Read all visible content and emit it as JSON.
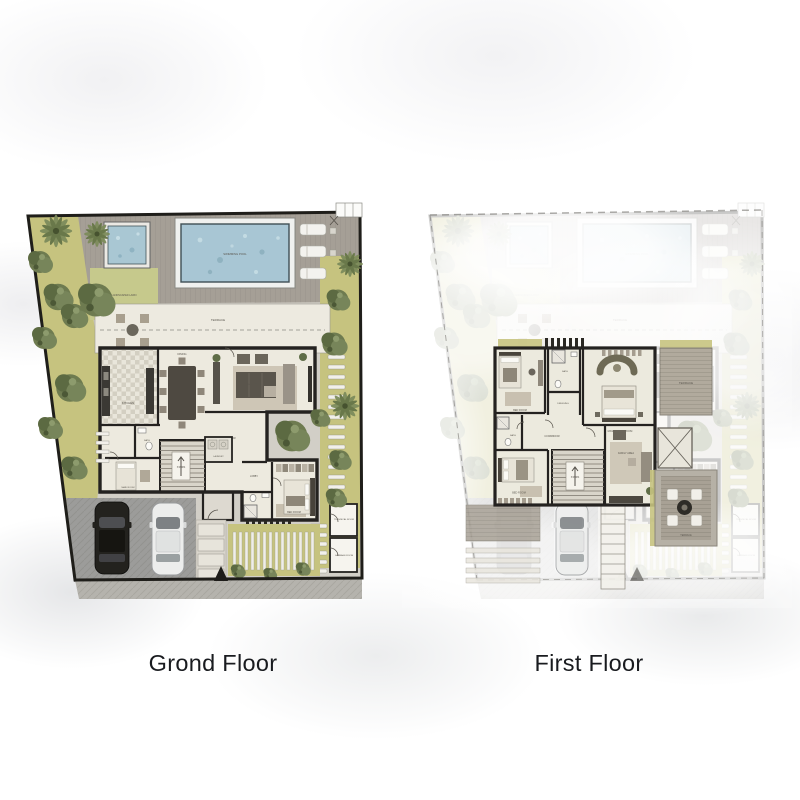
{
  "panels": {
    "ground": {
      "caption": "Grond Floor"
    },
    "first": {
      "caption": "First Floor"
    }
  },
  "ground_floor": {
    "labels": {
      "swimming_pool": "SWIMMING POOL",
      "lawn": "LANDSCAPED LAWN",
      "terrace": "TERRACE",
      "kitchen": "KITCHEN",
      "dining": "DINING",
      "salon": "SALON",
      "corridor": "CORRIDOR",
      "stairs": "STAIRS",
      "laundry": "LAUNDRY",
      "lobby": "LOBBY",
      "maid_room": "MAID ROOM",
      "bath": "BATH",
      "bedroom": "BED ROOM",
      "technical_room": "TECHNICAL ROOM",
      "garbage_room": "GARBAGE ROOM"
    },
    "north_marker": "▲"
  },
  "first_floor": {
    "labels": {
      "bedroom_2": "BED ROOM",
      "bath_1": "BATH",
      "dressing": "DRESSING",
      "master_bedroom": "MASTER BED ROOM",
      "terrace_upper": "TERRACE",
      "corridor": "CORRIDOR",
      "stairs": "STAIRS",
      "family": "FAMILY AREA",
      "bedroom_3": "BED ROOM",
      "bath_2": "BATH",
      "terrace_outdoor": "TERRACE"
    }
  },
  "colors": {
    "wall": "#242220",
    "pool_water": "#a8c6d4",
    "greenery": "#c6c37f",
    "tree": "#6e7b50",
    "deck": "#a59f96",
    "floor": "#edeadf",
    "driveway": "#9c9c9a",
    "caption_text": "#191b1f"
  }
}
